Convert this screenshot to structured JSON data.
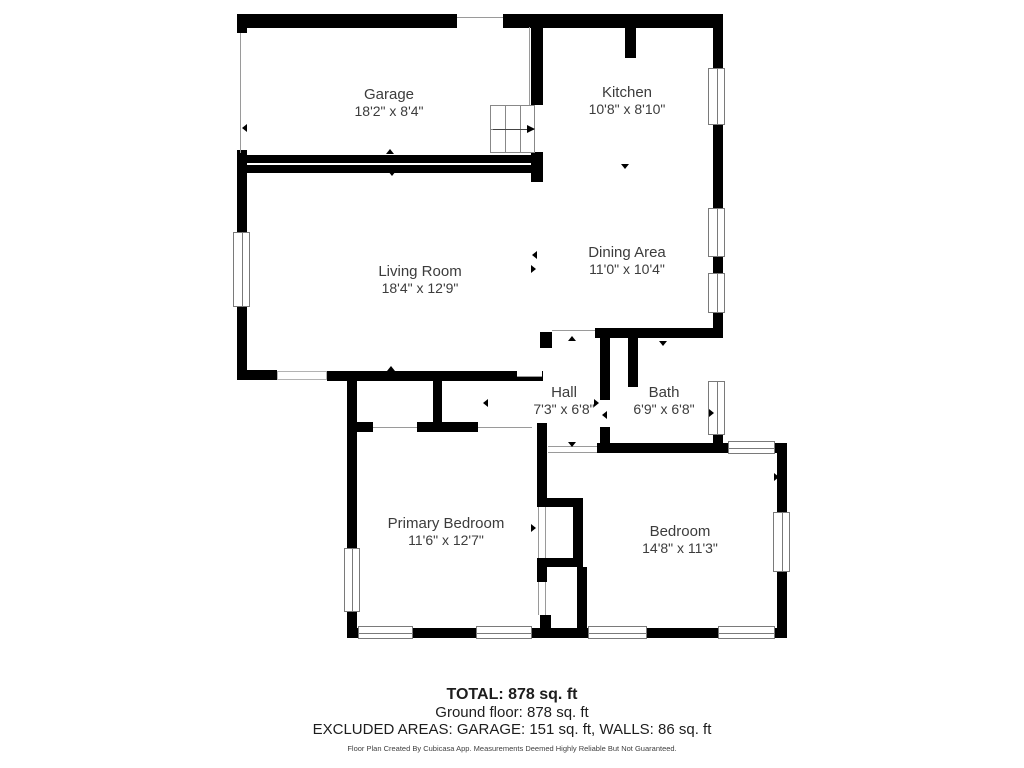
{
  "rooms": [
    {
      "name": "Garage",
      "dims": "18'2\" x 8'4\""
    },
    {
      "name": "Kitchen",
      "dims": "10'8\" x 8'10\""
    },
    {
      "name": "Living Room",
      "dims": "18'4\" x 12'9\""
    },
    {
      "name": "Dining Area",
      "dims": "11'0\" x 10'4\""
    },
    {
      "name": "Hall",
      "dims": "7'3\" x 6'8\""
    },
    {
      "name": "Bath",
      "dims": "6'9\" x 6'8\""
    },
    {
      "name": "Primary Bedroom",
      "dims": "11'6\" x 12'7\""
    },
    {
      "name": "Bedroom",
      "dims": "14'8\" x 11'3\""
    }
  ],
  "summary": {
    "total": "TOTAL: 878 sq. ft",
    "ground_floor": "Ground floor: 878 sq. ft",
    "excluded": "EXCLUDED AREAS: GARAGE: 151 sq. ft, WALLS: 86 sq. ft",
    "disclaimer": "Floor Plan Created By Cubicasa App. Measurements Deemed Highly Reliable But Not Guaranteed."
  },
  "colors": {
    "wall": "#000000",
    "label_text": "#3c3c3c",
    "window_frame": "#7a7a7a"
  }
}
